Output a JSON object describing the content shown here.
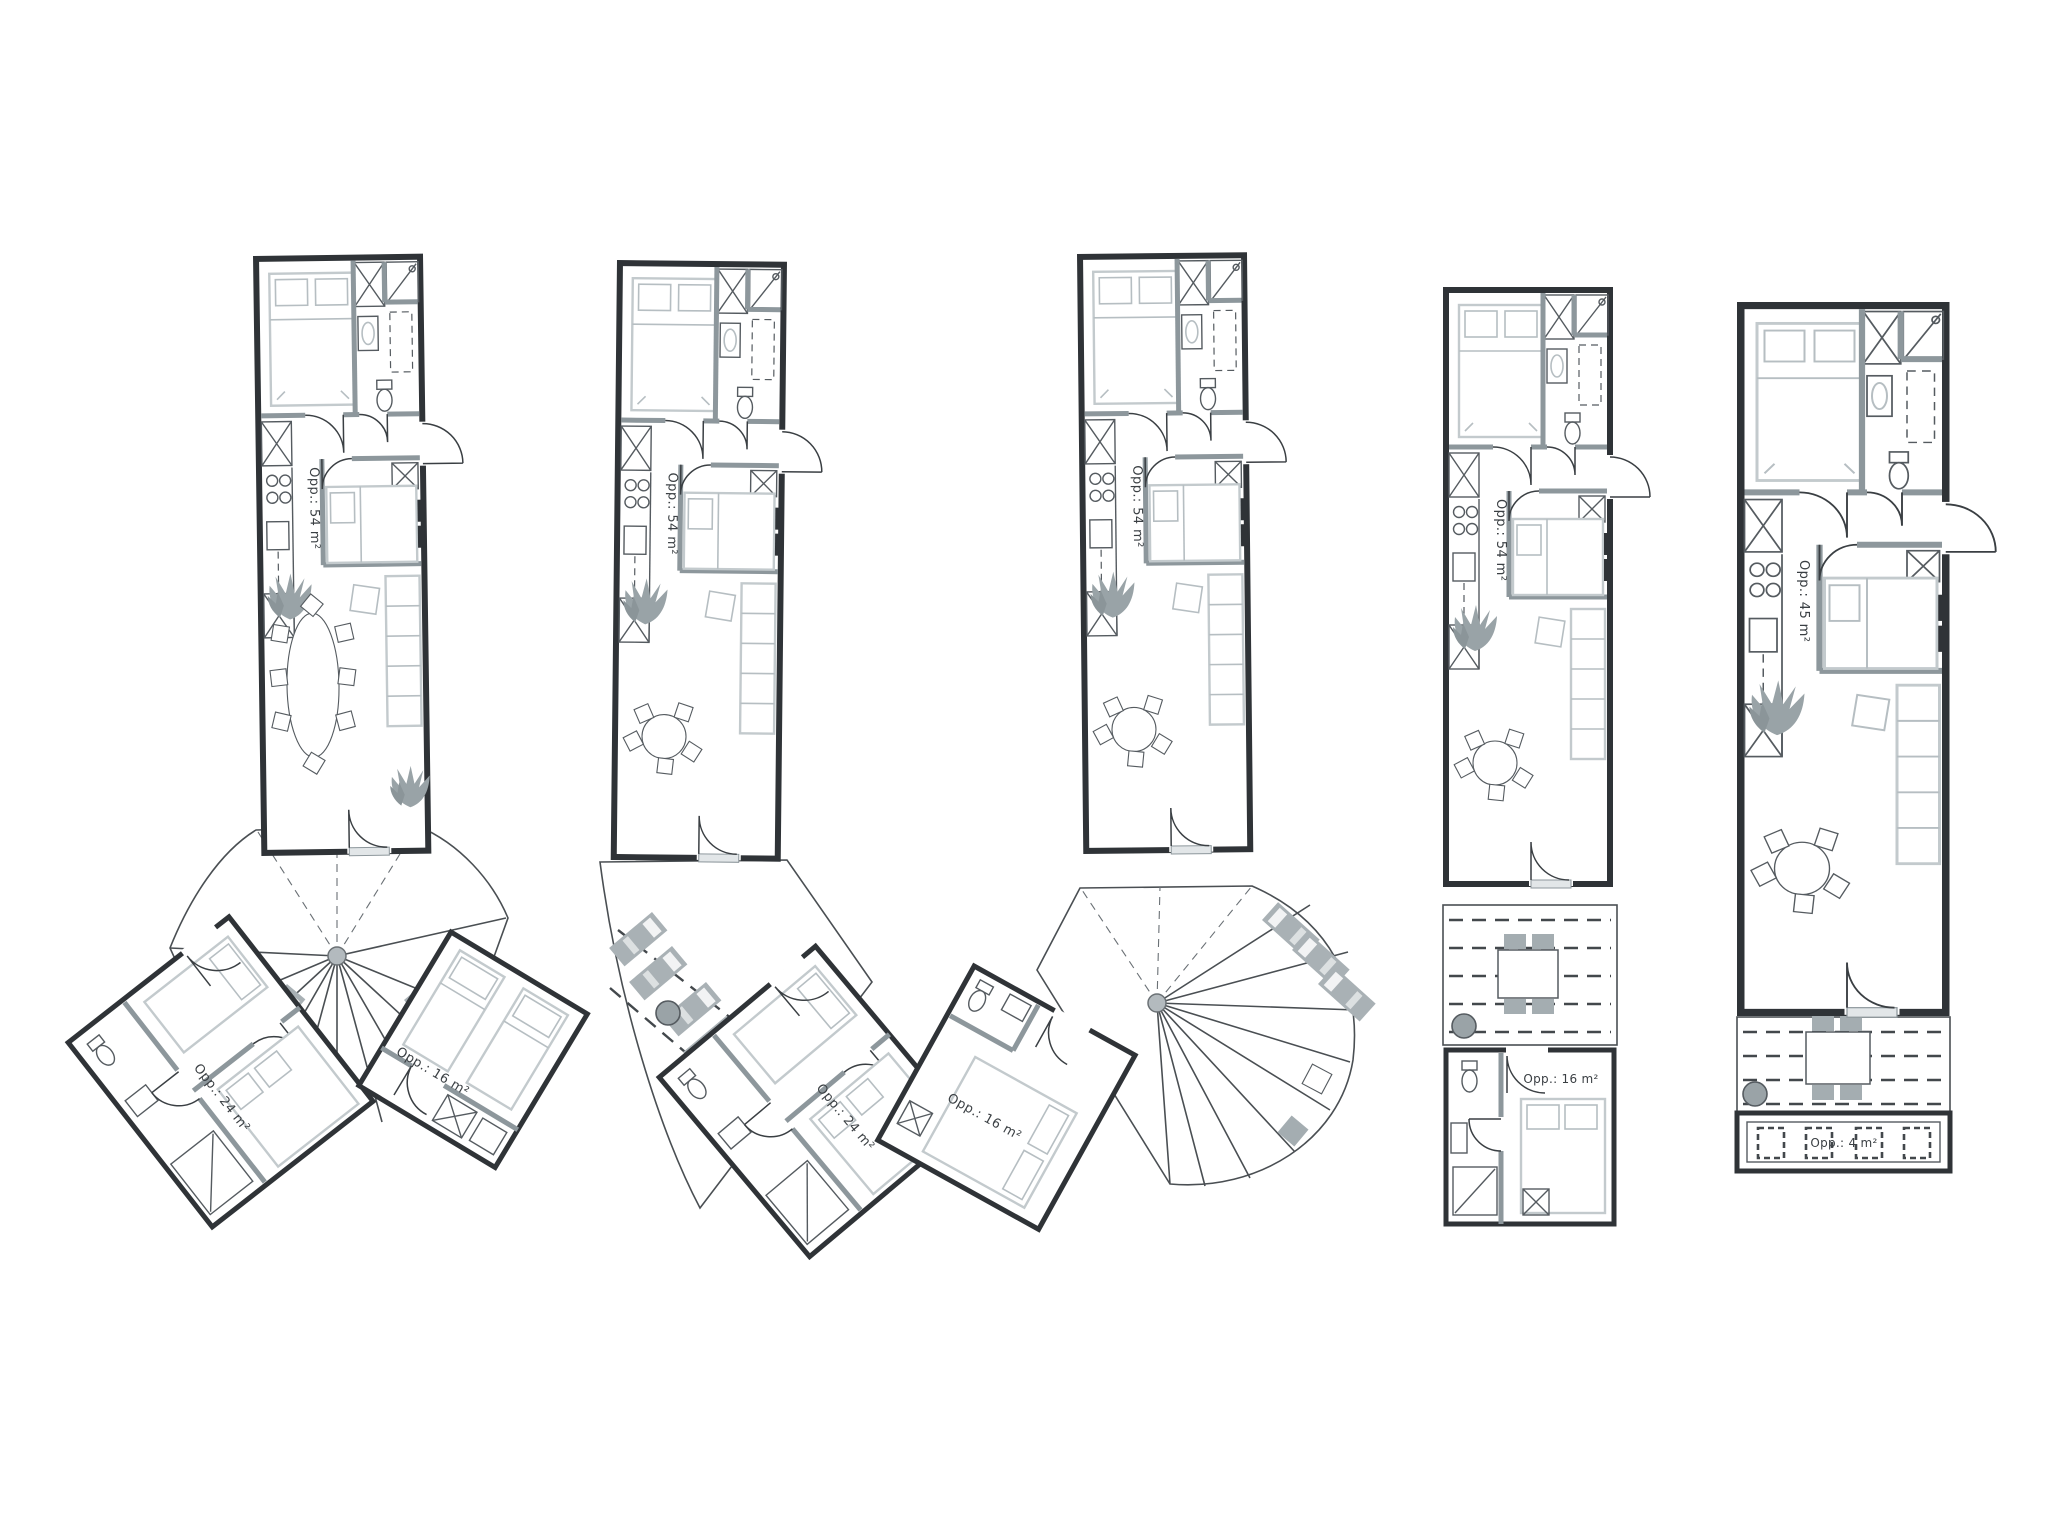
{
  "drawing": {
    "background": "#ffffff",
    "wall_color": "#2f3337",
    "interior_wall_color": "#8d979c",
    "furniture_line_color": "#c3cacd",
    "deck_line_color": "#c2c9cc",
    "accent_gray": "#a4adb1",
    "plans": [
      {
        "label_main": "Opp.: 54 m²",
        "label_room_left": "Opp.: 24 m²",
        "label_room_right": "Opp.: 16 m²"
      },
      {
        "label_main": "Opp.: 54 m²",
        "label_room": "Opp.: 24 m²"
      },
      {
        "label_main": "Opp.: 54 m²",
        "label_room": "Opp.: 16 m²"
      },
      {
        "label_main": "Opp.: 54 m²",
        "label_annex": "Opp.: 16 m²"
      },
      {
        "label_main": "Opp.: 45 m²",
        "label_storage": "Opp.: 4 m²"
      }
    ]
  }
}
